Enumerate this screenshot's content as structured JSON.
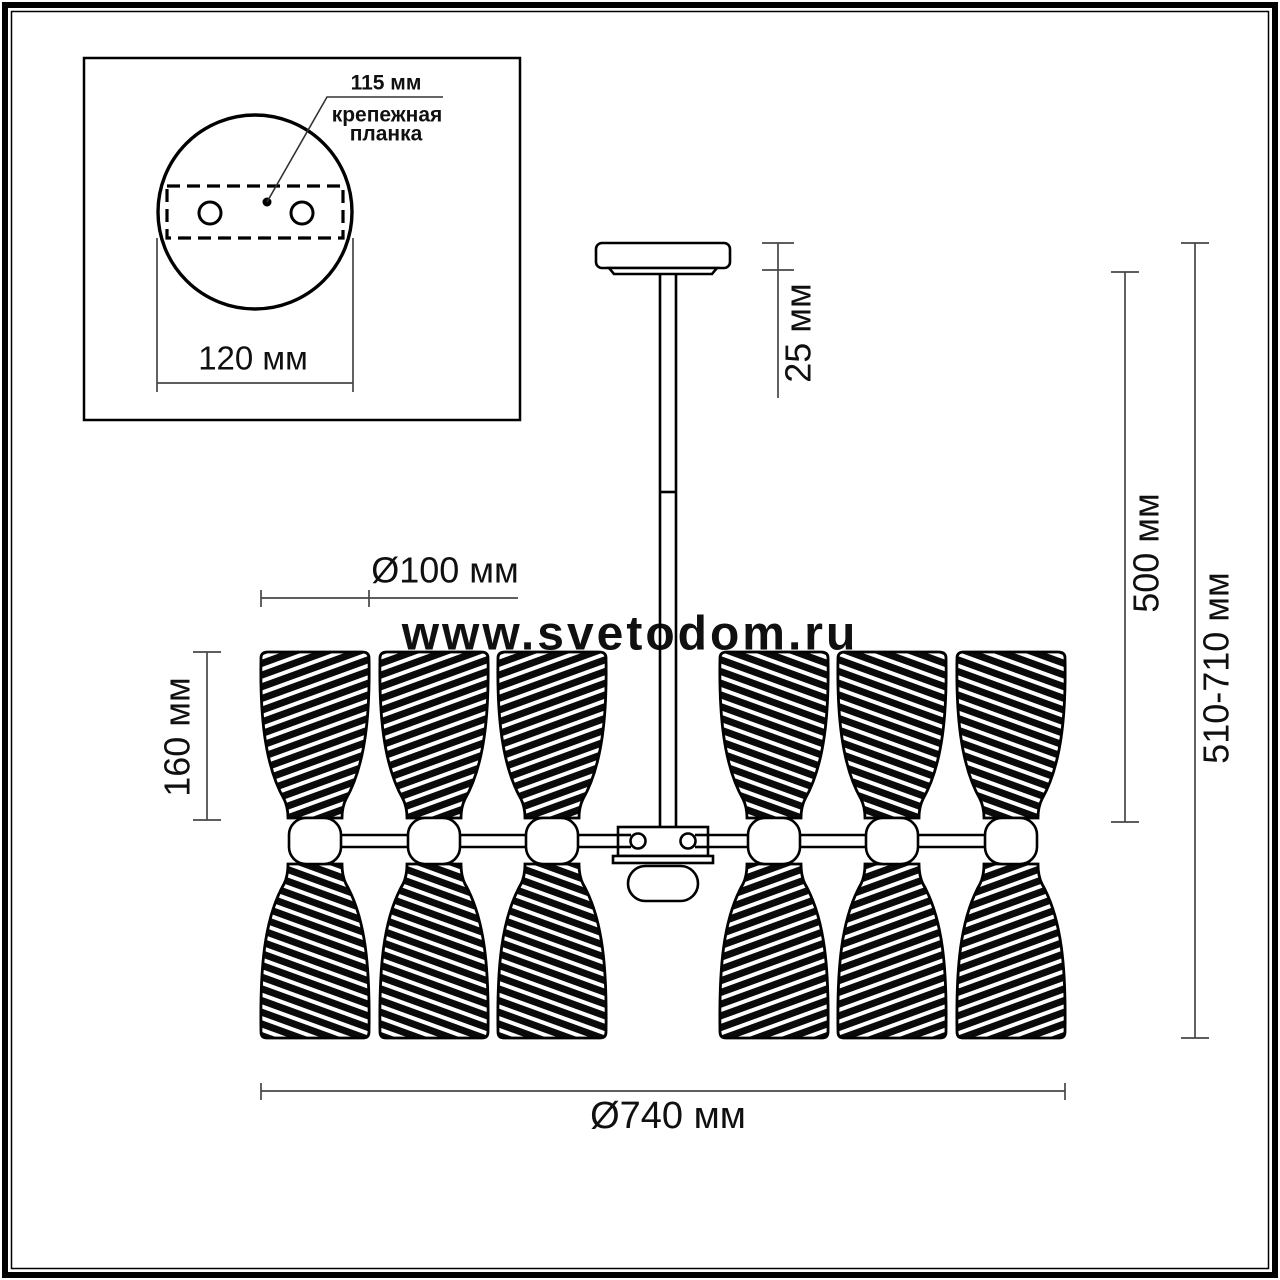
{
  "watermark": {
    "text": "www.svetodom.ru",
    "color": "#e6dcdc"
  },
  "inset_detail": {
    "hole_spacing_label": "115 мм",
    "bracket_label_line1": "крепежная",
    "bracket_label_line2": "планка",
    "canopy_diameter_label": "120 мм"
  },
  "dimensions": {
    "canopy_height_label": "25 мм",
    "rod_section_label": "500 мм",
    "overall_height_label": "510-710 мм",
    "shade_diameter_label": "Ø100 мм",
    "shade_height_label": "160 мм",
    "overall_diameter_label": "Ø740 мм"
  },
  "colors": {
    "line": "#000000",
    "dimension_line": "#474747",
    "watermark": "#e6dcdc",
    "background": "#ffffff"
  }
}
